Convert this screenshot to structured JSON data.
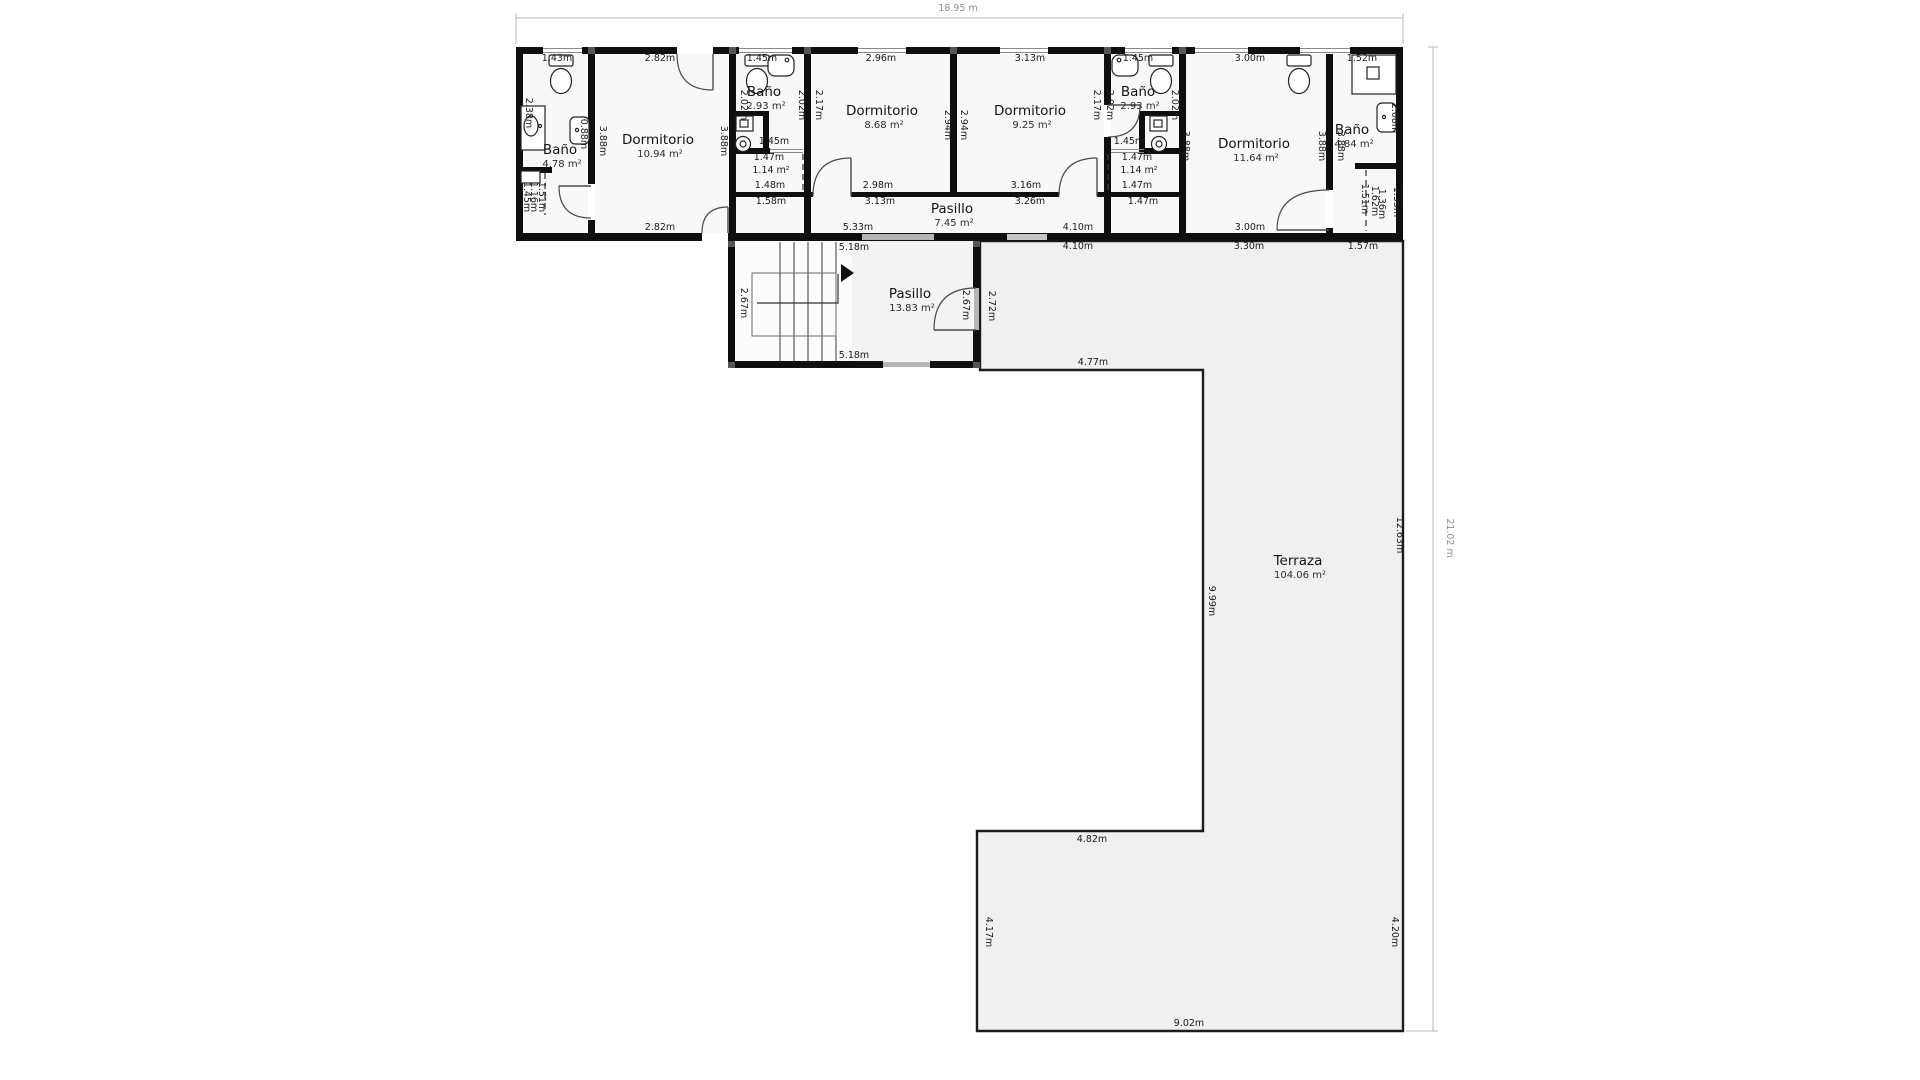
{
  "floorplan": {
    "type": "floor-plan",
    "overall": {
      "width": "18.95 m",
      "height": "21.02 m"
    },
    "rooms": [
      {
        "name": "Baño",
        "area": "4.78 m²",
        "x": 560,
        "y": 154
      },
      {
        "name": "Dormitorio",
        "area": "10.94 m²",
        "x": 658,
        "y": 144
      },
      {
        "name": "Baño",
        "area": "2.93 m²",
        "x": 764,
        "y": 96
      },
      {
        "name": "Dormitorio",
        "area": "8.68 m²",
        "x": 882,
        "y": 115
      },
      {
        "name": "Dormitorio",
        "area": "9.25 m²",
        "x": 1030,
        "y": 115
      },
      {
        "name": "Baño",
        "area": "2.93 m²",
        "x": 1138,
        "y": 96
      },
      {
        "name": "Dormitorio",
        "area": "11.64 m²",
        "x": 1254,
        "y": 148
      },
      {
        "name": "Baño",
        "area": "4.84 m²",
        "x": 1352,
        "y": 134
      },
      {
        "name": "Pasillo",
        "area": "7.45 m²",
        "x": 952,
        "y": 213
      },
      {
        "name": "Pasillo",
        "area": "13.83 m²",
        "x": 910,
        "y": 298
      },
      {
        "name": "Terraza",
        "area": "104.06 m²",
        "x": 1298,
        "y": 565
      }
    ],
    "measurements": [
      {
        "t": "1.43m",
        "x": 557,
        "y": 61
      },
      {
        "t": "2.82m",
        "x": 660,
        "y": 61
      },
      {
        "t": "1.45m",
        "x": 762,
        "y": 61
      },
      {
        "t": "2.96m",
        "x": 881,
        "y": 61
      },
      {
        "t": "3.13m",
        "x": 1030,
        "y": 61
      },
      {
        "t": "1.45m",
        "x": 1138,
        "y": 61
      },
      {
        "t": "3.00m",
        "x": 1250,
        "y": 61
      },
      {
        "t": "1.52m",
        "x": 1362,
        "y": 61
      },
      {
        "t": "2.38m",
        "x": 526,
        "y": 113,
        "r": 1
      },
      {
        "t": "0.88m",
        "x": 581,
        "y": 134,
        "r": 1
      },
      {
        "t": "3.88m",
        "x": 600,
        "y": 141,
        "r": 1
      },
      {
        "t": "3.88m",
        "x": 721,
        "y": 141,
        "r": 1
      },
      {
        "t": "2.02m",
        "x": 741,
        "y": 105,
        "r": 1
      },
      {
        "t": "2.02m",
        "x": 799,
        "y": 105,
        "r": 1
      },
      {
        "t": "2.17m",
        "x": 816,
        "y": 105,
        "r": 1
      },
      {
        "t": "2.94m",
        "x": 945,
        "y": 125,
        "r": 1
      },
      {
        "t": "2.94m",
        "x": 961,
        "y": 125,
        "r": 1
      },
      {
        "t": "2.17m",
        "x": 1094,
        "y": 105,
        "r": 1
      },
      {
        "t": "2.02m",
        "x": 1107,
        "y": 105,
        "r": 1
      },
      {
        "t": "2.02m",
        "x": 1172,
        "y": 105,
        "r": 1
      },
      {
        "t": "3.88m",
        "x": 1183,
        "y": 146,
        "r": 1
      },
      {
        "t": "3.88m",
        "x": 1319,
        "y": 146,
        "r": 1
      },
      {
        "t": "3.88m",
        "x": 1338,
        "y": 146,
        "r": 1
      },
      {
        "t": "2.08m",
        "x": 1392,
        "y": 118,
        "r": 1
      },
      {
        "t": "1.45m",
        "x": 524,
        "y": 197,
        "r": 1
      },
      {
        "t": "1.16m",
        "x": 531,
        "y": 197,
        "r": 1
      },
      {
        "t": "1.51m",
        "x": 539,
        "y": 197,
        "r": 1
      },
      {
        "t": "1.51m",
        "x": 1362,
        "y": 199,
        "r": 1
      },
      {
        "t": "1.62m",
        "x": 1372,
        "y": 201,
        "r": 1
      },
      {
        "t": "1.36m",
        "x": 1379,
        "y": 204,
        "r": 1
      },
      {
        "t": "1.35m",
        "x": 1394,
        "y": 202,
        "r": 1
      },
      {
        "t": "1.45m",
        "x": 774,
        "y": 144
      },
      {
        "t": "1.45m",
        "x": 1129,
        "y": 144
      },
      {
        "t": "1.47m",
        "x": 769,
        "y": 160
      },
      {
        "t": "1.14 m²",
        "x": 771,
        "y": 173
      },
      {
        "t": "1.48m",
        "x": 770,
        "y": 188
      },
      {
        "t": "1.47m",
        "x": 1137,
        "y": 160
      },
      {
        "t": "1.14 m²",
        "x": 1139,
        "y": 173
      },
      {
        "t": "1.47m",
        "x": 1137,
        "y": 188
      },
      {
        "t": "2.98m",
        "x": 878,
        "y": 188
      },
      {
        "t": "3.16m",
        "x": 1026,
        "y": 188
      },
      {
        "t": "1.58m",
        "x": 771,
        "y": 204
      },
      {
        "t": "3.13m",
        "x": 880,
        "y": 204
      },
      {
        "t": "3.26m",
        "x": 1030,
        "y": 204
      },
      {
        "t": "1.47m",
        "x": 1143,
        "y": 204
      },
      {
        "t": "2.82m",
        "x": 660,
        "y": 230
      },
      {
        "t": "5.33m",
        "x": 858,
        "y": 230
      },
      {
        "t": "4.10m",
        "x": 1078,
        "y": 230
      },
      {
        "t": "3.00m",
        "x": 1250,
        "y": 230
      },
      {
        "t": "5.18m",
        "x": 854,
        "y": 250
      },
      {
        "t": "4.10m",
        "x": 1078,
        "y": 249
      },
      {
        "t": "3.30m",
        "x": 1249,
        "y": 249
      },
      {
        "t": "1.57m",
        "x": 1363,
        "y": 249
      },
      {
        "t": "5.18m",
        "x": 854,
        "y": 358
      },
      {
        "t": "2.67m",
        "x": 741,
        "y": 303,
        "r": 1
      },
      {
        "t": "2.67m",
        "x": 963,
        "y": 305,
        "r": 1
      },
      {
        "t": "2.72m",
        "x": 989,
        "y": 306,
        "r": 1
      },
      {
        "t": "4.77m",
        "x": 1093,
        "y": 365
      },
      {
        "t": "4.82m",
        "x": 1092,
        "y": 842
      },
      {
        "t": "9.02m",
        "x": 1189,
        "y": 1026
      },
      {
        "t": "9.99m",
        "x": 1209,
        "y": 601,
        "r": 1
      },
      {
        "t": "4.17m",
        "x": 986,
        "y": 932,
        "r": 1
      },
      {
        "t": "4.20m",
        "x": 1392,
        "y": 932,
        "r": 1
      },
      {
        "t": "12.63m",
        "x": 1397,
        "y": 535,
        "r": 1
      }
    ],
    "fixtures": [
      "toilet",
      "sink",
      "vanity",
      "shower",
      "washing-machine",
      "stairs",
      "door",
      "window"
    ]
  }
}
